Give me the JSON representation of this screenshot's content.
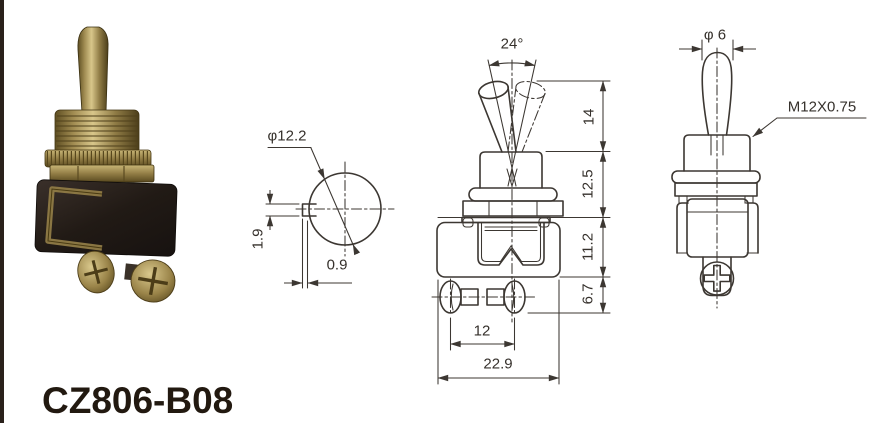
{
  "product_code": "CZ806-B08",
  "top_view": {
    "diameter_label": "φ12.2",
    "key_height_label": "1.9",
    "key_depth_label": "0.9"
  },
  "front_view": {
    "angle_label": "24°",
    "lever_height_label": "14",
    "bushing_height_label": "12.5",
    "body_height_label": "11.2",
    "terminal_height_label": "6.7",
    "screw_spacing_label": "12",
    "overall_width_label": "22.9"
  },
  "side_view": {
    "lever_width_label": "φ 6",
    "thread_label": "M12X0.75"
  },
  "colors": {
    "line": "#3c3732",
    "brass": "#a08a4e",
    "body_black": "#241d18"
  }
}
